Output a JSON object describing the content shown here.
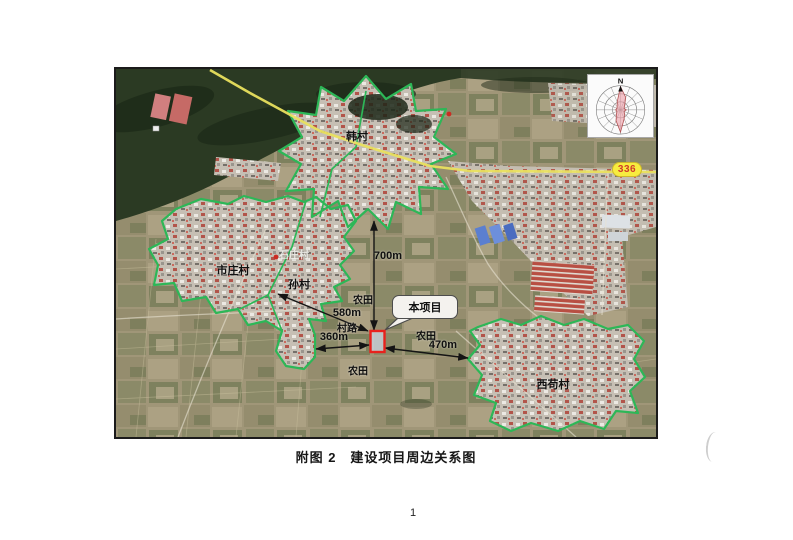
{
  "page": {
    "caption": "附图 2　建设项目周边关系图",
    "page_number": "1"
  },
  "map": {
    "compass_north": "N",
    "road_badge": "336",
    "project_label": "本项目",
    "villages": {
      "hancun": "韩村",
      "shizhuang": "市庄村",
      "suncun": "孙村",
      "xigou": "西苟村",
      "basemap_faint": "石庄村"
    },
    "land": {
      "farmland_north": "农田",
      "farmland_east": "农田",
      "farmland_south": "农田",
      "village_road": "村路"
    },
    "distances": {
      "to_hancun": "700m",
      "to_suncun": "580m",
      "to_village_road_west": "360m",
      "to_xigou": "470m"
    },
    "colors": {
      "village_boundary": "#2db757",
      "highway": "#e9e05e",
      "project_marker": "#e8211d",
      "badge_bg": "#f7ec3f",
      "badge_text": "#d03a2a"
    }
  }
}
